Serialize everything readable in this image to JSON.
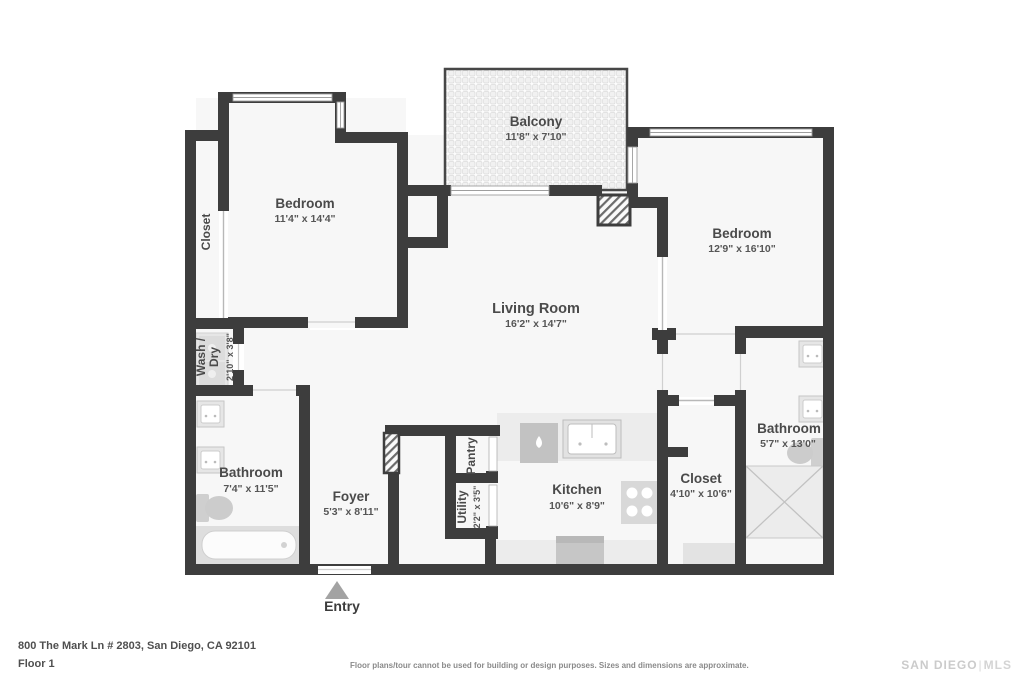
{
  "colors": {
    "wall": "#3d3d3d",
    "floor": "#f7f7f7",
    "label_text": "#4a4a4a",
    "fixture_light": "#e9e9e9",
    "fixture_mid": "#c6c6c6",
    "entry_arrow": "#a3a3a3",
    "brand_gray": "#cbcbcb"
  },
  "plan": {
    "balcony": {
      "name": "Balcony",
      "dims": "11'8\" x 7'10\""
    },
    "bedroom_left": {
      "name": "Bedroom",
      "dims": "11'4\" x 14'4\""
    },
    "closet_left": {
      "name": "Closet"
    },
    "wash_dry": {
      "line1": "Wash /",
      "line2": "Dry",
      "dims": "2'10\" x 3'8\""
    },
    "bathroom_left": {
      "name": "Bathroom",
      "dims": "7'4\" x 11'5\""
    },
    "foyer": {
      "name": "Foyer",
      "dims": "5'3\" x 8'11\""
    },
    "entry": {
      "label": "Entry"
    },
    "pantry": {
      "name": "Pantry"
    },
    "utility": {
      "name": "Utility",
      "dims": "2'2\" x 3'5\""
    },
    "kitchen": {
      "name": "Kitchen",
      "dims": "10'6\" x 8'9\""
    },
    "living_room": {
      "name": "Living Room",
      "dims": "16'2\" x 14'7\""
    },
    "bedroom_right": {
      "name": "Bedroom",
      "dims": "12'9\" x 16'10\""
    },
    "closet_right": {
      "name": "Closet",
      "dims": "4'10\" x 10'6\""
    },
    "bathroom_right": {
      "name": "Bathroom",
      "dims": "5'7\" x 13'0\""
    }
  },
  "footer": {
    "address": "800 The Mark Ln # 2803, San Diego, CA 92101",
    "floor_label": "Floor 1",
    "disclaimer": "Floor plans/tour cannot be used for building or design purposes. Sizes and dimensions are approximate.",
    "brand": {
      "left": "SAN DIEGO",
      "right": "MLS"
    }
  }
}
